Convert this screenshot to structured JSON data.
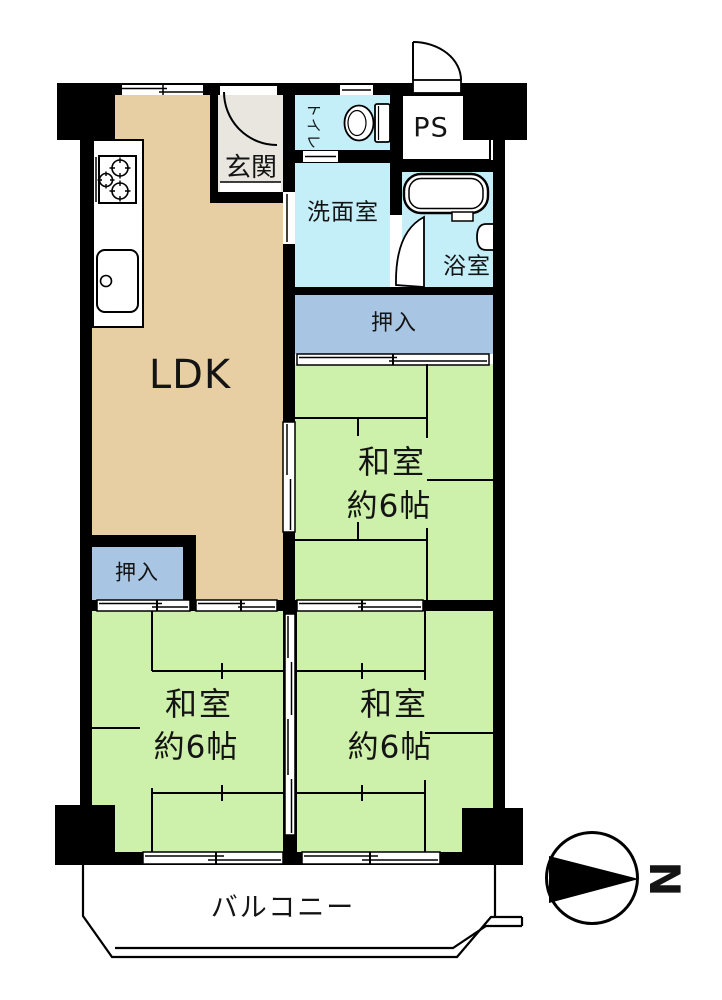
{
  "rooms": {
    "ldk": {
      "label": "LDK"
    },
    "genkan": {
      "label": "玄関"
    },
    "toilet": {
      "label": "トイレ"
    },
    "ps": {
      "label": "PS"
    },
    "washroom": {
      "label": "洗面室"
    },
    "bathroom": {
      "label": "浴室"
    },
    "closet_upper": {
      "label": "押入"
    },
    "closet_lower": {
      "label": "押入"
    },
    "washitsu_middle": {
      "label": "和室",
      "size": "約6帖"
    },
    "washitsu_bottom_left": {
      "label": "和室",
      "size": "約6帖"
    },
    "washitsu_bottom_right": {
      "label": "和室",
      "size": "約6帖"
    },
    "balcony": {
      "label": "バルコニー"
    }
  },
  "compass": {
    "north_label": "N"
  },
  "colors": {
    "wall": "#000000",
    "ldk_floor": "#e7cfa3",
    "tatami_floor": "#cdf0aa",
    "wet_area_floor": "#c4eff8",
    "closet_floor": "#a9c5e4",
    "genkan_floor": "#e9e6e0",
    "line": "#000000",
    "background": "#ffffff"
  },
  "icons": {
    "north_arrow": "black-triangle-in-circle",
    "stove": "three-burner-cooktop",
    "kitchen_sink": "rounded-basin-with-faucet-dot",
    "toilet": "toilet-bowl-with-tank",
    "bathtub": "double-outline-rounded-tub",
    "bathroom_basin": "wall-mounted-half-round-basin",
    "doors": "quarter-circle-swing-arcs",
    "sliding_doors": "staggered-double-line-tracks"
  }
}
